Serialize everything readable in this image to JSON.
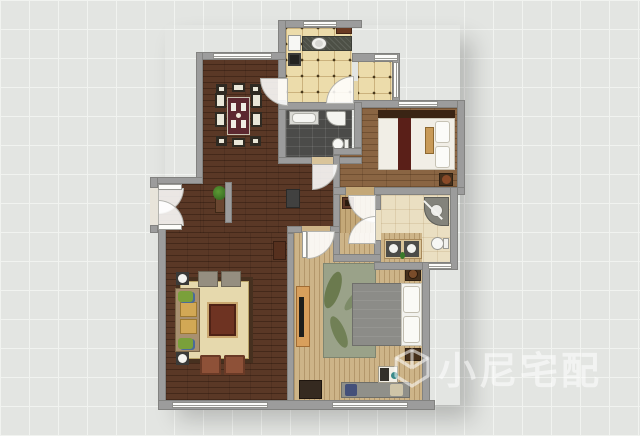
{
  "watermark": {
    "text": "小尼宅配",
    "logo": "cube-logo-icon"
  },
  "palette": {
    "bg": "#e3e5e2",
    "grid": "#f1f3f0",
    "wall": "#9c9c9c",
    "wallBorder": "#828280",
    "darkWood": "#5a3826",
    "lightWood": "#cdb488",
    "hallWood": "#c4a878",
    "bed2Wood": "#8a6543",
    "tile": "#ecdcab",
    "bath1": "#4b4b49",
    "bath2": "#eadfc2",
    "rugLiving": "#e6d9ad",
    "rugLivingBorder": "#46301f",
    "rugMaster": "#9aa289",
    "diningTable": "#5c2830",
    "sofaTan": "#a89070",
    "counterGranite": "#4d5046",
    "watermark": "rgba(255,255,255,0.55)"
  }
}
